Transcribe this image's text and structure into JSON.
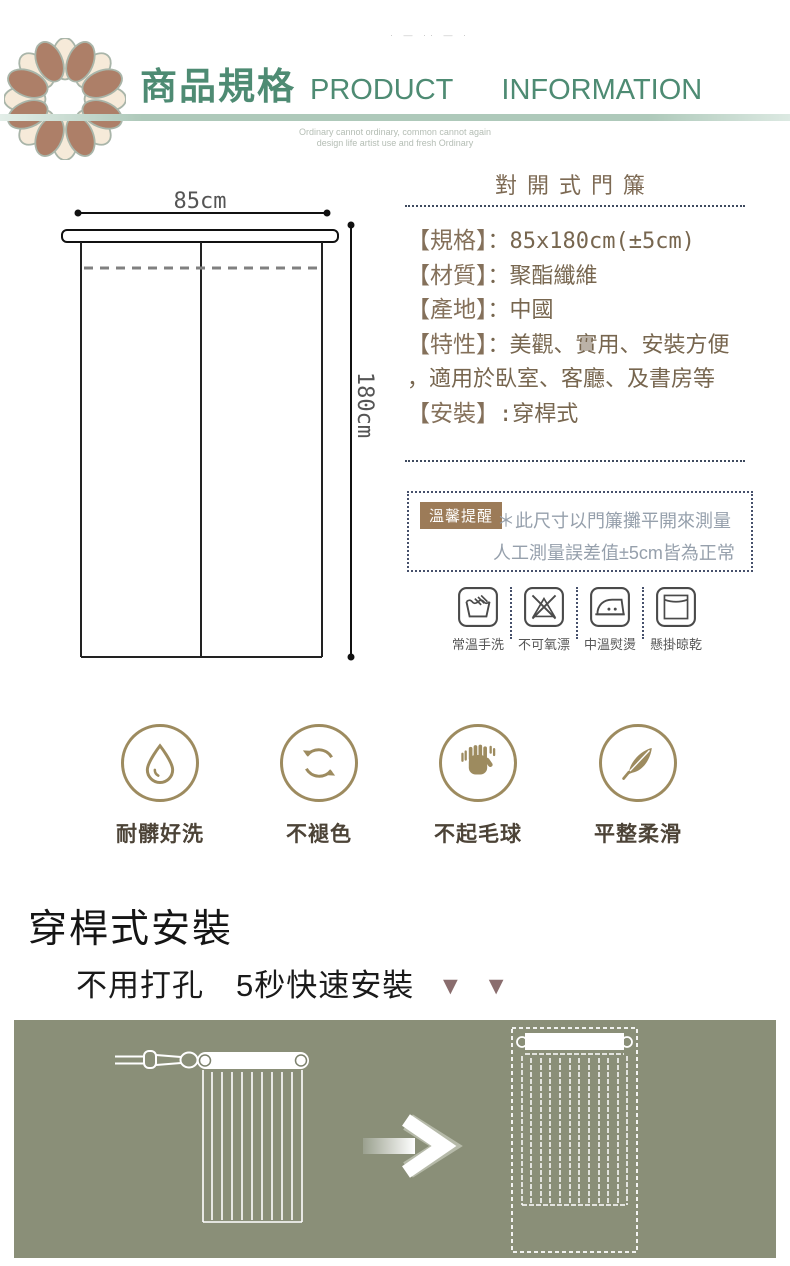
{
  "header": {
    "watermark": "· — ·· — ·",
    "title_zh": "商品規格",
    "title_en_word1": "PRODUCT",
    "title_en_word2": "INFORMATION",
    "slogan_line1": "Ordinary cannot ordinary, common cannot again",
    "slogan_line2": "design life artist use and fresh Ordinary"
  },
  "diagram": {
    "width_label": "85cm",
    "height_label": "180cm"
  },
  "product": {
    "title": "對開式門簾",
    "specs": [
      {
        "label": "【規格】",
        "value": "：85x180cm(±5cm)"
      },
      {
        "label": "【材質】",
        "value": "：聚酯纖維"
      },
      {
        "label": "【產地】",
        "value": "：中國"
      },
      {
        "label": "【特性】",
        "value": "：美觀、實用、安裝方便"
      },
      {
        "label": "",
        "value": "，適用於臥室、客廳、及書房等"
      },
      {
        "label": "【安裝】",
        "value": ":穿桿式"
      }
    ]
  },
  "reminder": {
    "badge": "溫馨提醒",
    "line1": "＊此尺寸以門簾攤平開來測量",
    "line2": "人工測量誤差值±5cm皆為正常"
  },
  "care": {
    "items": [
      {
        "icon": "hand-wash-icon",
        "label": "常溫手洗"
      },
      {
        "icon": "no-bleach-icon",
        "label": "不可氧漂"
      },
      {
        "icon": "iron-medium-icon",
        "label": "中溫熨燙"
      },
      {
        "icon": "hang-dry-icon",
        "label": "懸掛晾乾"
      }
    ]
  },
  "features": {
    "items": [
      {
        "icon": "water-drop-icon",
        "label": "耐髒好洗"
      },
      {
        "icon": "refresh-arrows-icon",
        "label": "不褪色"
      },
      {
        "icon": "hand-icon",
        "label": "不起毛球"
      },
      {
        "icon": "feather-icon",
        "label": "平整柔滑"
      }
    ]
  },
  "install": {
    "title": "穿桿式安裝",
    "subtitle": "不用打孔　5秒快速安裝",
    "arrows": "▼ ▼"
  },
  "colors": {
    "accent_teal": "#4e8b73",
    "brown_text": "#84705a",
    "badge_bg": "#9c7b58",
    "reminder_text": "#96a0ac",
    "feature_gold": "#9d8b5f",
    "panel_olive": "#8a8f78",
    "triangle_mauve": "#8a6d6e"
  }
}
